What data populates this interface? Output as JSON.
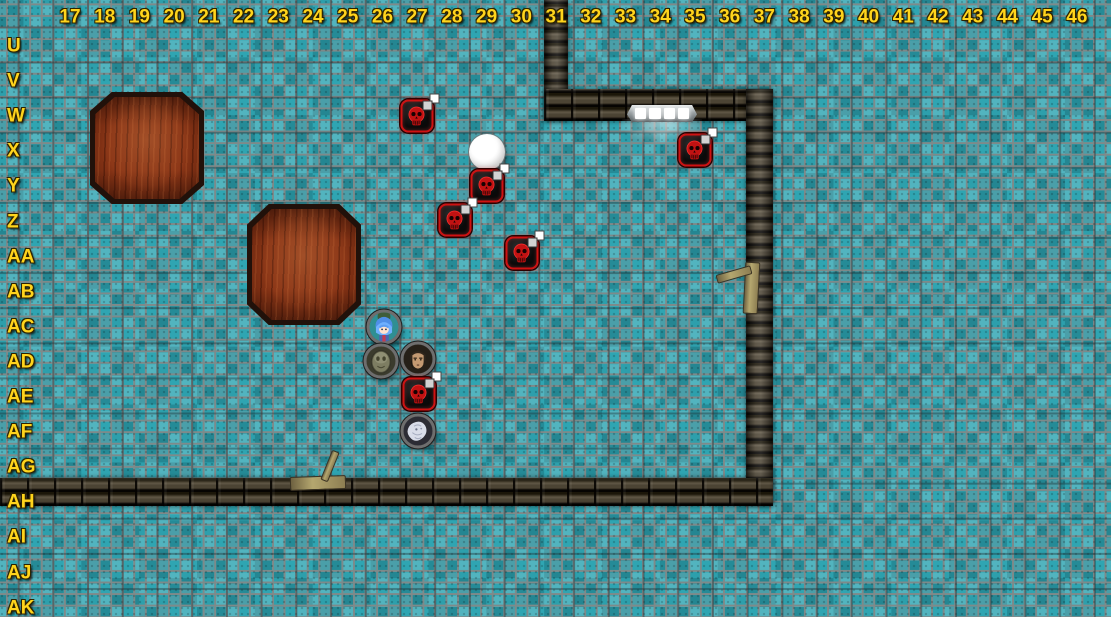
{
  "map": {
    "kind": "vtt-dungeon-battle-map",
    "width": 1111,
    "height": 617
  },
  "grid": {
    "column_labels": [
      "17",
      "18",
      "19",
      "20",
      "21",
      "22",
      "23",
      "24",
      "25",
      "26",
      "27",
      "28",
      "29",
      "30",
      "31",
      "32",
      "33",
      "34",
      "35",
      "36",
      "37",
      "38",
      "39",
      "40",
      "41",
      "42",
      "43",
      "44",
      "45",
      "46"
    ],
    "row_labels": [
      "U",
      "V",
      "W",
      "X",
      "Y",
      "Z",
      "AA",
      "AB",
      "AC",
      "AD",
      "AE",
      "AF",
      "AG",
      "AH",
      "AI",
      "AJ",
      "AK"
    ],
    "label_color": "#ffd41c",
    "col_origin_x": 70,
    "col_spacing": 34.72,
    "col_label_y": 17,
    "row_origin_y": 46,
    "row_spacing": 35.1,
    "row_label_x": 7
  },
  "floor": {
    "tile_mid": "#2fa5b2",
    "tile_light": "#4abec9",
    "tile_dark": "#15808d",
    "grout": "#7e8a8a",
    "small_tile_size": 11.57,
    "grid_cell_size": 34.72
  },
  "walls": {
    "brick_light": "#5d5443",
    "brick_dark": "#1b1609",
    "mortar": "#060402",
    "segments": [
      {
        "name": "wall-top-vertical",
        "x": 544,
        "y": 0,
        "w": 24,
        "h": 121,
        "orient": "v"
      },
      {
        "name": "wall-top-horizontal",
        "x": 544,
        "y": 89,
        "w": 229,
        "h": 32,
        "orient": "h"
      },
      {
        "name": "wall-right-vertical",
        "x": 746,
        "y": 89,
        "w": 27,
        "h": 417,
        "orient": "v"
      },
      {
        "name": "wall-bottom-horizontal",
        "x": 0,
        "y": 478,
        "w": 773,
        "h": 28,
        "orient": "h"
      }
    ]
  },
  "door_light": {
    "x": 627,
    "y": 105,
    "w": 70,
    "h": 17,
    "panel_count": 4,
    "glow_color": "#ffffff"
  },
  "furniture": [
    {
      "name": "wooden-table-1",
      "x": 90,
      "y": 92,
      "w": 114,
      "h": 112
    },
    {
      "name": "wooden-table-2",
      "x": 247,
      "y": 204,
      "w": 114,
      "h": 121
    }
  ],
  "debris": [
    {
      "name": "bone-debris-right-wall",
      "x": 714,
      "y": 258,
      "variant": "vertical"
    },
    {
      "name": "bone-debris-bottom-wall",
      "x": 288,
      "y": 448,
      "variant": "horizontal"
    }
  ],
  "tokens": [
    {
      "name": "enemy-skull-1",
      "kind": "skull",
      "cell": "27-W",
      "x": 417,
      "y": 116,
      "badge": true
    },
    {
      "name": "white-orb",
      "kind": "orb",
      "cell": "29-X",
      "x": 487,
      "y": 152,
      "badge": false
    },
    {
      "name": "enemy-skull-2",
      "kind": "skull",
      "cell": "29-Y",
      "x": 487,
      "y": 186,
      "badge": true
    },
    {
      "name": "enemy-skull-3",
      "kind": "skull",
      "cell": "28-Z",
      "x": 455,
      "y": 220,
      "badge": true
    },
    {
      "name": "enemy-skull-4",
      "kind": "skull",
      "cell": "30-AA",
      "x": 522,
      "y": 253,
      "badge": true
    },
    {
      "name": "enemy-skull-5",
      "kind": "skull",
      "cell": "35-X",
      "x": 695,
      "y": 150,
      "badge": true
    },
    {
      "name": "pc-blue-haired-girl",
      "kind": "girl",
      "cell": "26-AC",
      "x": 384,
      "y": 327,
      "badge": false
    },
    {
      "name": "pc-ghostly-figure",
      "kind": "ghost",
      "cell": "26-AD",
      "x": 381,
      "y": 361,
      "badge": false
    },
    {
      "name": "pc-dark-haired-man",
      "kind": "man",
      "cell": "27-AD",
      "x": 418,
      "y": 359,
      "badge": false
    },
    {
      "name": "enemy-skull-6",
      "kind": "skull",
      "cell": "27-AE",
      "x": 419,
      "y": 394,
      "badge": true
    },
    {
      "name": "pc-pale-creature",
      "kind": "pale",
      "cell": "27-AF",
      "x": 418,
      "y": 431,
      "badge": false
    }
  ]
}
